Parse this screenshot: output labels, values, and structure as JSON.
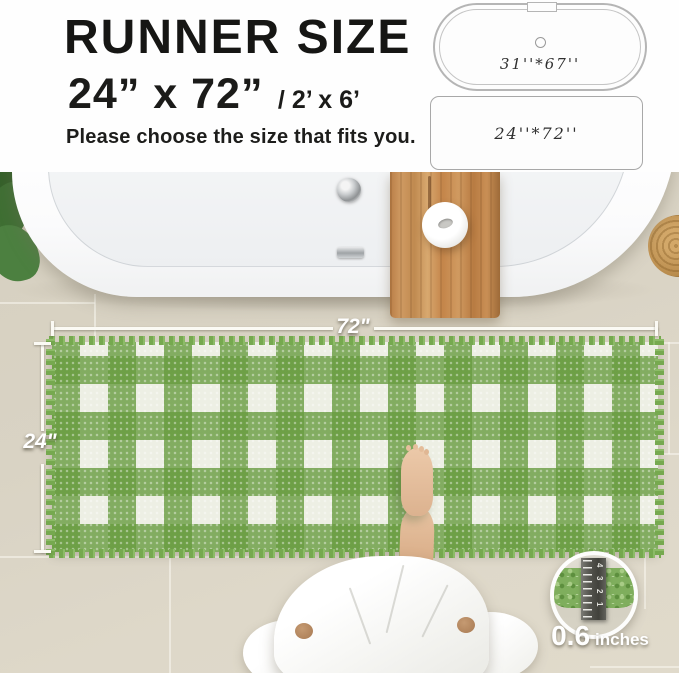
{
  "header": {
    "title": "RUNNER SIZE",
    "size_primary": "24”  x 72”",
    "size_secondary": "/ 2’ x 6’",
    "subtitle": "Please choose the size that fits you."
  },
  "size_diagrams": {
    "bathtub_label": "31''*67''",
    "runner_label": "24''*72''"
  },
  "scene": {
    "width_dimension_label": "72\"",
    "height_dimension_label": "24\""
  },
  "pile_inset": {
    "value": "0.6",
    "unit": "inches",
    "ruler_numbers": [
      "4",
      "3",
      "2",
      "1"
    ]
  },
  "palette": {
    "rug_green": "#6fa44c",
    "rug_white": "#edefe4",
    "floor_beige": "#d8d2c2",
    "wood_brown": "#c38a52",
    "text_dark": "#1b1b19"
  }
}
